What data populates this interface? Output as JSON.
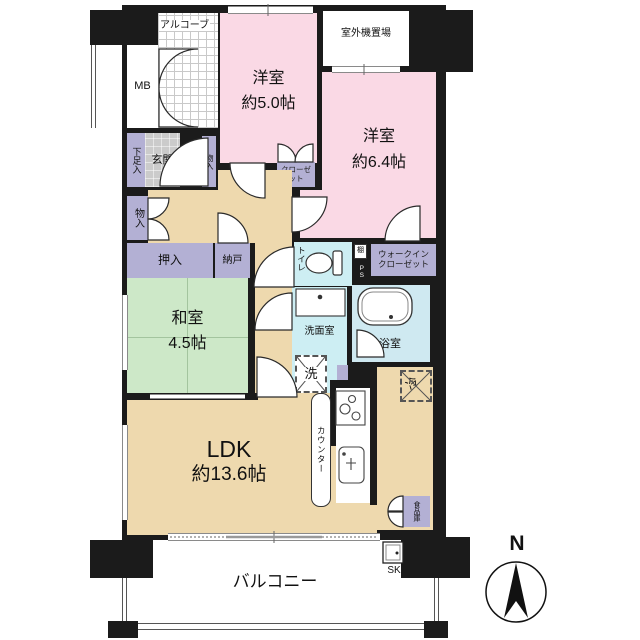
{
  "plan": {
    "rooms": {
      "alcove": "アルコーブ",
      "mb": "MB",
      "bedroom1_name": "洋室",
      "bedroom1_area": "約5.0帖",
      "outdoor_unit": "室外機置場",
      "bedroom2_name": "洋室",
      "bedroom2_area": "約6.4帖",
      "closet": "クローゼット",
      "shoe_cabinet": "下足入",
      "entrance": "玄関",
      "storage_small": "物入",
      "storage_left": "物入",
      "oshiire": "押入",
      "nando": "納戸",
      "washitsu_name": "和室",
      "washitsu_area": "4.5帖",
      "toilet": "トイレ",
      "shelf": "棚",
      "ps": "PS",
      "walk_in_closet": "ウォークインクローゼット",
      "washroom": "洗面室",
      "washer": "洗",
      "bathroom": "浴室",
      "fridge": "冷",
      "ldk_name": "LDK",
      "ldk_area": "約13.6帖",
      "counter": "カウンター",
      "pantry": "食品庫",
      "balcony": "バルコニー",
      "sk": "SK"
    },
    "compass": {
      "north_label": "N"
    },
    "colors": {
      "wall": "#1b1b1b",
      "bedroom_pink": "#fad9e5",
      "ldk_tan": "#eed9ae",
      "washitsu_green": "#cde8c8",
      "closet_purple": "#b3b0d4",
      "sanitary_cyan": "#cdeef3",
      "bath_blue": "#cfe9f1",
      "entrance_gray": "#cbcbcb"
    }
  }
}
